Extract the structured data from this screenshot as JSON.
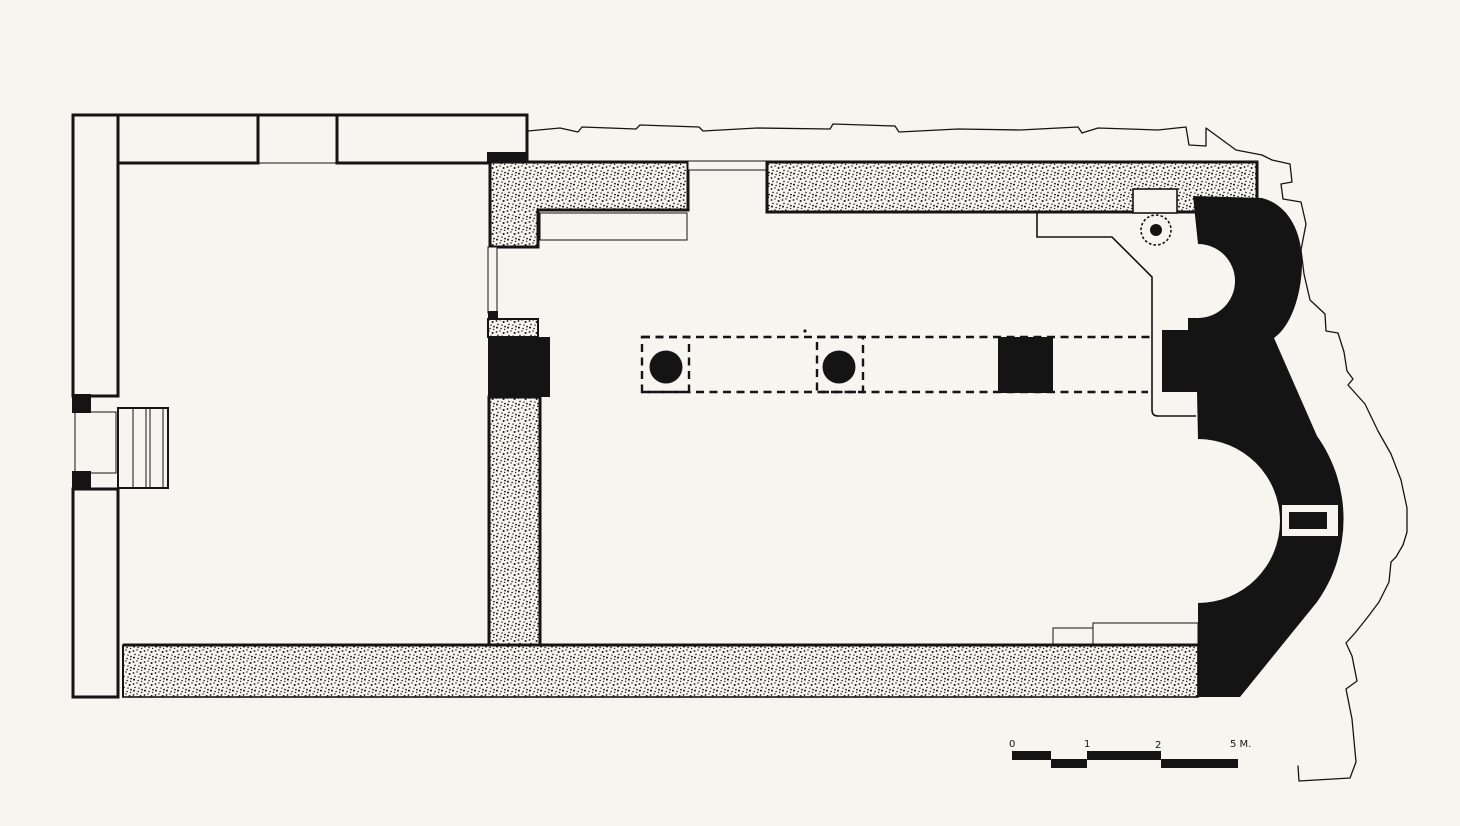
{
  "figure": {
    "kind": "church-floor-plan-drawing",
    "colors": {
      "paper": "#f6f5f0",
      "ink": "#141414",
      "css_vars": "--paper:#f6f5f0; --ink:#141414"
    },
    "scale_bar": {
      "labels": [
        "0",
        "1",
        "2",
        "5 M."
      ]
    }
  }
}
